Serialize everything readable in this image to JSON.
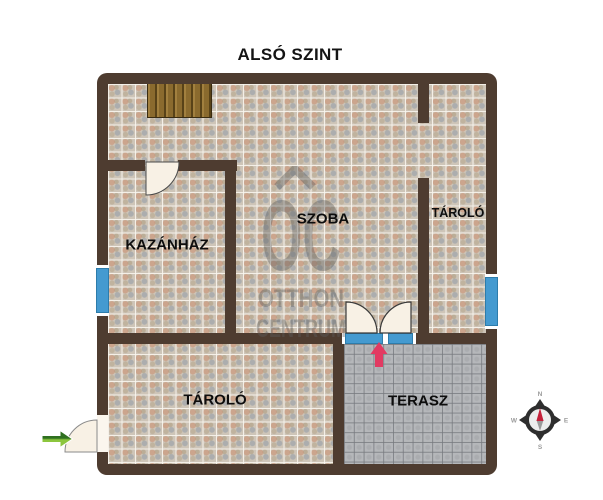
{
  "title": "ALSÓ SZINT",
  "rooms": {
    "kazanhaz": "KAZÁNHÁZ",
    "szoba": "SZOBA",
    "tarolo_felso": "TÁROLÓ",
    "tarolo_also": "TÁROLÓ",
    "terasz": "TERASZ"
  },
  "watermark": {
    "logo": "OC",
    "line1": "OTTHON",
    "line2": "CENTRUM"
  },
  "compass": {
    "north": "N",
    "east": "E",
    "south": "S",
    "west": "W"
  },
  "colors": {
    "wall_brown": "#4e3c30",
    "window_blue": "#449ad0",
    "door_fill": "#f8f1e5",
    "stairs_wood": "#8a6a2e",
    "entry_arrow_green_dark": "#2f7020",
    "entry_arrow_green_light": "#8cc63e",
    "terasz_arrow_pink": "#e23a62",
    "compass_needle_red": "#c5203a",
    "compass_needle_gray": "#9a9a9a",
    "watermark_gray": "#5e5e5e"
  }
}
